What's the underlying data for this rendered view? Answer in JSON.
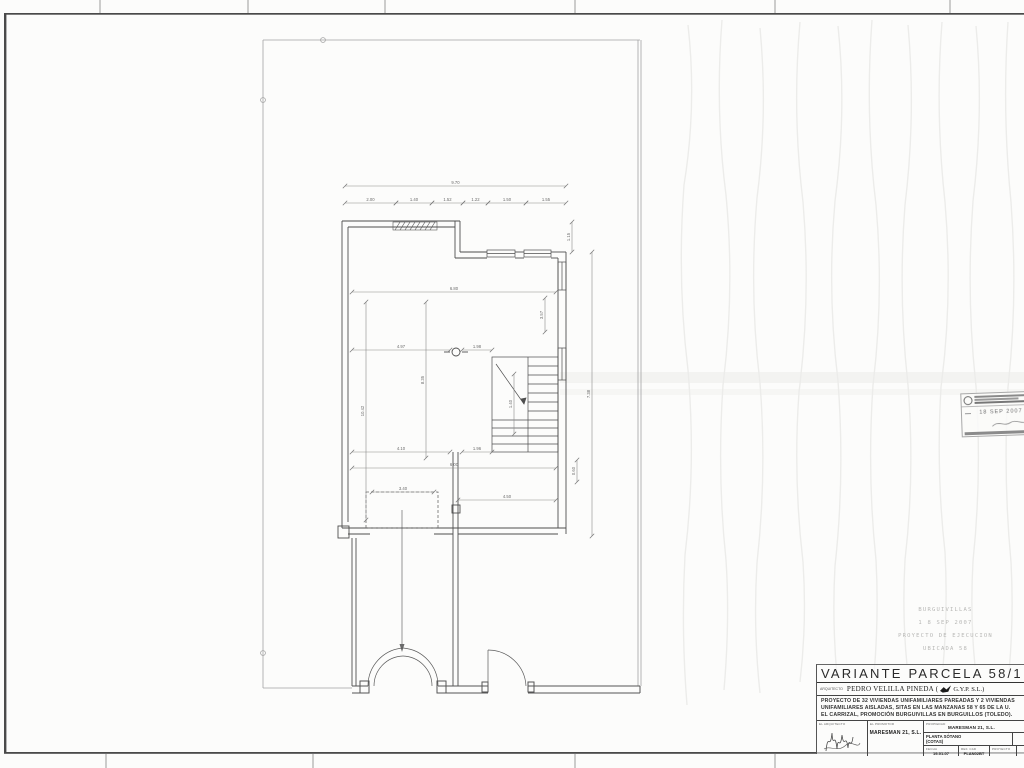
{
  "sheet": {
    "title": "VARIANTE PARCELA 58/1",
    "architect": {
      "label": "ARQUITECTO",
      "name": "PEDRO VELILLA PINEDA (",
      "firm": "G.Y.P. S.L.)"
    },
    "description": {
      "line1": "PROYECTO DE 32 VIVIENDAS UNIFAMILIARES PAREADAS Y 2 VIVIENDAS",
      "line2": "UNIFAMILIARES AISLADAS, SITAS EN LAS MANZANAS 58 Y 65 DE LA U.",
      "line3": "EL CARRIZAL, PROMOCIÓN BURGUIVILLAS EN BURGUILLOS (TOLEDO)."
    },
    "titleblock": {
      "arquitecto_label": "EL ARQUITECTO",
      "promotor_label": "EL PROMOTOR",
      "promotor_value": "MARESMAN 21, S.L.",
      "propiedad_label": "PROPIEDAD",
      "propiedad_value": "MARESMAN 21, S.L.",
      "plano_line1": "PLANTA SÓTANO",
      "plano_line2": "(COTAS)",
      "fecha_label": "FECHA",
      "fecha_value": "19-01-07",
      "refcad_label": "REF. CAD",
      "refcad_value": "PLAN02BT",
      "proyecto_label": "PROYECTO"
    }
  },
  "stamps": {
    "visado": {
      "date": "18 SEP 2007"
    },
    "faint": {
      "line1": "BURGUIVILLAS",
      "line2": "1 8 SEP 2007",
      "line3": "PROYECTO DE EJECUCION",
      "line4": "UBICADA 58"
    }
  },
  "plan": {
    "dimensions": [
      {
        "label": "9.70",
        "x1": 345,
        "y1": 186,
        "x2": 566,
        "y2": 186
      },
      {
        "label": "2.00",
        "x1": 345,
        "y1": 203,
        "x2": 396,
        "y2": 203
      },
      {
        "label": "1.40",
        "x1": 396,
        "y1": 203,
        "x2": 432,
        "y2": 203
      },
      {
        "label": "1.52",
        "x1": 432,
        "y1": 203,
        "x2": 463,
        "y2": 203
      },
      {
        "label": "1.22",
        "x1": 463,
        "y1": 203,
        "x2": 488,
        "y2": 203
      },
      {
        "label": "1.50",
        "x1": 488,
        "y1": 203,
        "x2": 526,
        "y2": 203
      },
      {
        "label": "1.55",
        "x1": 526,
        "y1": 203,
        "x2": 566,
        "y2": 203
      },
      {
        "label": "1.15",
        "x1": 572,
        "y1": 222,
        "x2": 572,
        "y2": 252,
        "vertical": true
      },
      {
        "label": "6.80",
        "x1": 352,
        "y1": 292,
        "x2": 556,
        "y2": 292
      },
      {
        "label": "3.57",
        "x1": 545,
        "y1": 298,
        "x2": 545,
        "y2": 332,
        "vertical": true
      },
      {
        "label": "4.97",
        "x1": 352,
        "y1": 350,
        "x2": 450,
        "y2": 350
      },
      {
        "label": "1.98",
        "x1": 462,
        "y1": 350,
        "x2": 492,
        "y2": 350
      },
      {
        "label": "10.42",
        "x1": 366,
        "y1": 302,
        "x2": 366,
        "y2": 520,
        "vertical": true
      },
      {
        "label": "8.35",
        "x1": 426,
        "y1": 302,
        "x2": 426,
        "y2": 458,
        "vertical": true
      },
      {
        "label": "7.38",
        "x1": 592,
        "y1": 252,
        "x2": 592,
        "y2": 536,
        "vertical": true
      },
      {
        "label": "1.40",
        "x1": 514,
        "y1": 374,
        "x2": 514,
        "y2": 434,
        "vertical": true
      },
      {
        "label": "4.10",
        "x1": 352,
        "y1": 452,
        "x2": 450,
        "y2": 452
      },
      {
        "label": "1.96",
        "x1": 462,
        "y1": 452,
        "x2": 492,
        "y2": 452
      },
      {
        "label": "6.00",
        "x1": 352,
        "y1": 468,
        "x2": 556,
        "y2": 468
      },
      {
        "label": "3.40",
        "x1": 372,
        "y1": 492,
        "x2": 434,
        "y2": 492
      },
      {
        "label": "4.50",
        "x1": 458,
        "y1": 500,
        "x2": 556,
        "y2": 500
      },
      {
        "label": "0.60",
        "x1": 577,
        "y1": 460,
        "x2": 577,
        "y2": 482,
        "vertical": true
      }
    ]
  }
}
